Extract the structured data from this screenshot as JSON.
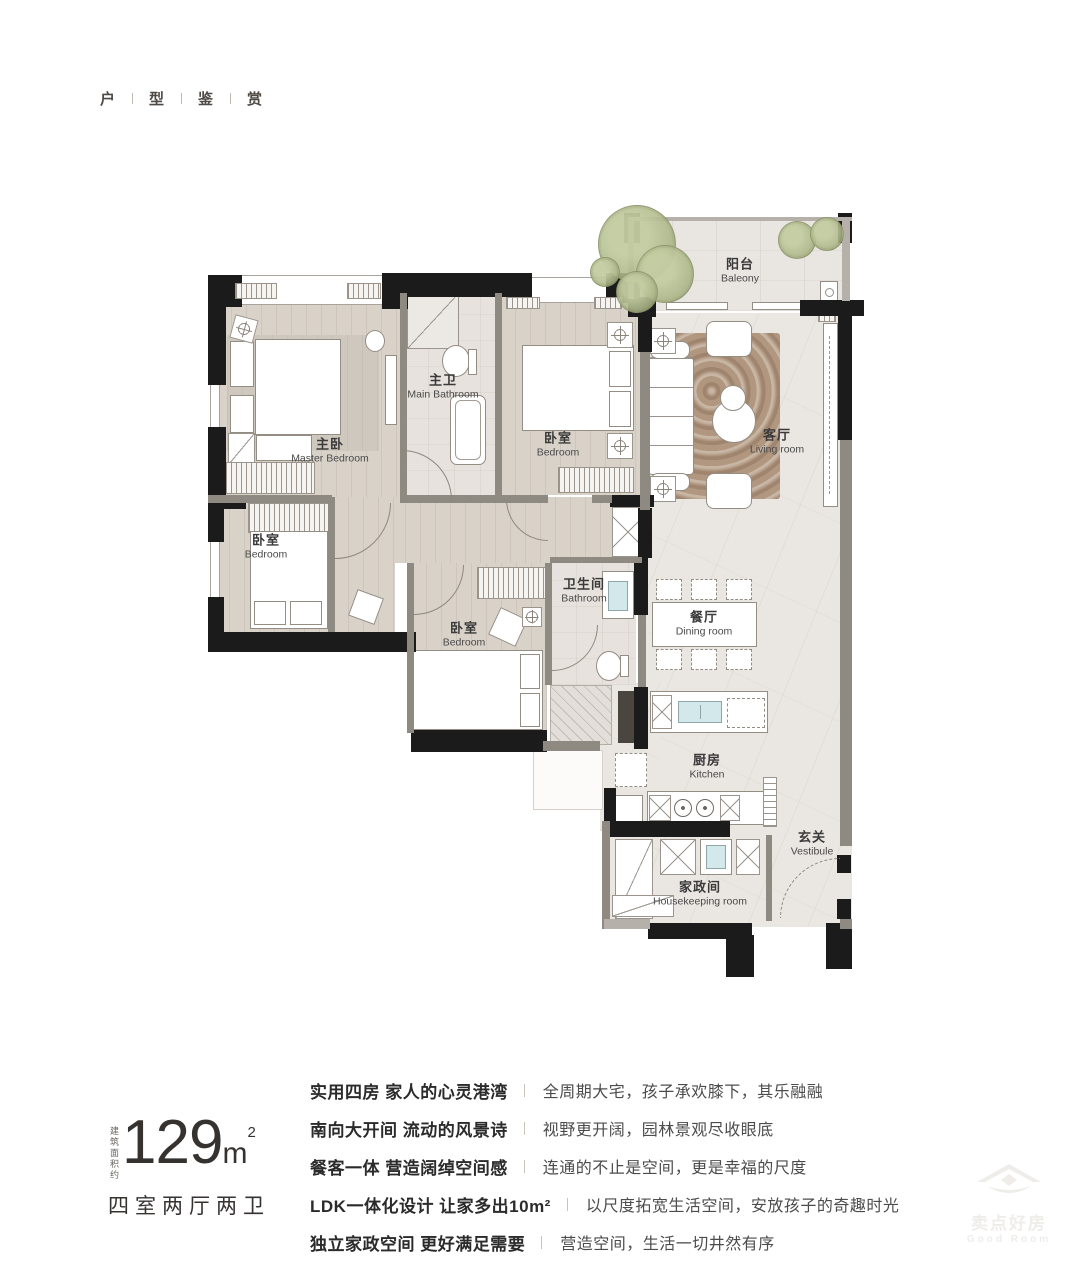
{
  "header": {
    "chars": [
      "户",
      "型",
      "鉴",
      "赏"
    ]
  },
  "plan": {
    "rooms": [
      {
        "id": "balcony",
        "zh": "阳台",
        "en": "Baleony"
      },
      {
        "id": "living-room",
        "zh": "客厅",
        "en": "Living room"
      },
      {
        "id": "master-bedroom",
        "zh": "主卧",
        "en": "Master Bedroom"
      },
      {
        "id": "main-bathroom",
        "zh": "主卫",
        "en": "Main Bathroom"
      },
      {
        "id": "bedroom-2",
        "zh": "卧室",
        "en": "Bedroom"
      },
      {
        "id": "bedroom-3",
        "zh": "卧室",
        "en": "Bedroom"
      },
      {
        "id": "bedroom-4",
        "zh": "卧室",
        "en": "Bedroom"
      },
      {
        "id": "bathroom",
        "zh": "卫生间",
        "en": "Bathroom"
      },
      {
        "id": "dining-room",
        "zh": "餐厅",
        "en": "Dining room"
      },
      {
        "id": "kitchen",
        "zh": "厨房",
        "en": "Kitchen"
      },
      {
        "id": "vestibule",
        "zh": "玄关",
        "en": "Vestibule"
      },
      {
        "id": "housekeeping",
        "zh": "家政间",
        "en": "Housekeeping  room"
      }
    ]
  },
  "area": {
    "note": "建筑面积约",
    "value": "129",
    "unit": "m",
    "sup": "2",
    "layout": "四室两厅两卫"
  },
  "features": [
    {
      "title": "实用四房 家人的心灵港湾",
      "desc": "全周期大宅，孩子承欢膝下，其乐融融"
    },
    {
      "title": "南向大开间 流动的风景诗",
      "desc": "视野更开阔，园林景观尽收眼底"
    },
    {
      "title": "餐客一体 营造阔绰空间感",
      "desc": "连通的不止是空间，更是幸福的尺度"
    },
    {
      "title": "LDK一体化设计 让家多出10m²",
      "desc": "以尺度拓宽生活空间，安放孩子的奇趣时光"
    },
    {
      "title": "独立家政空间 更好满足需要",
      "desc": "营造空间，生活一切井然有序"
    }
  ],
  "watermark": {
    "zh": "卖点好房",
    "en": "Good Room"
  },
  "colors": {
    "wall": "#1b1b1b",
    "floor_marble": "#eae6e1",
    "floor_wood": "#d9d2c9",
    "rug": "#b1977f",
    "tree": "#b3bc94",
    "text": "#3a3a3a"
  }
}
